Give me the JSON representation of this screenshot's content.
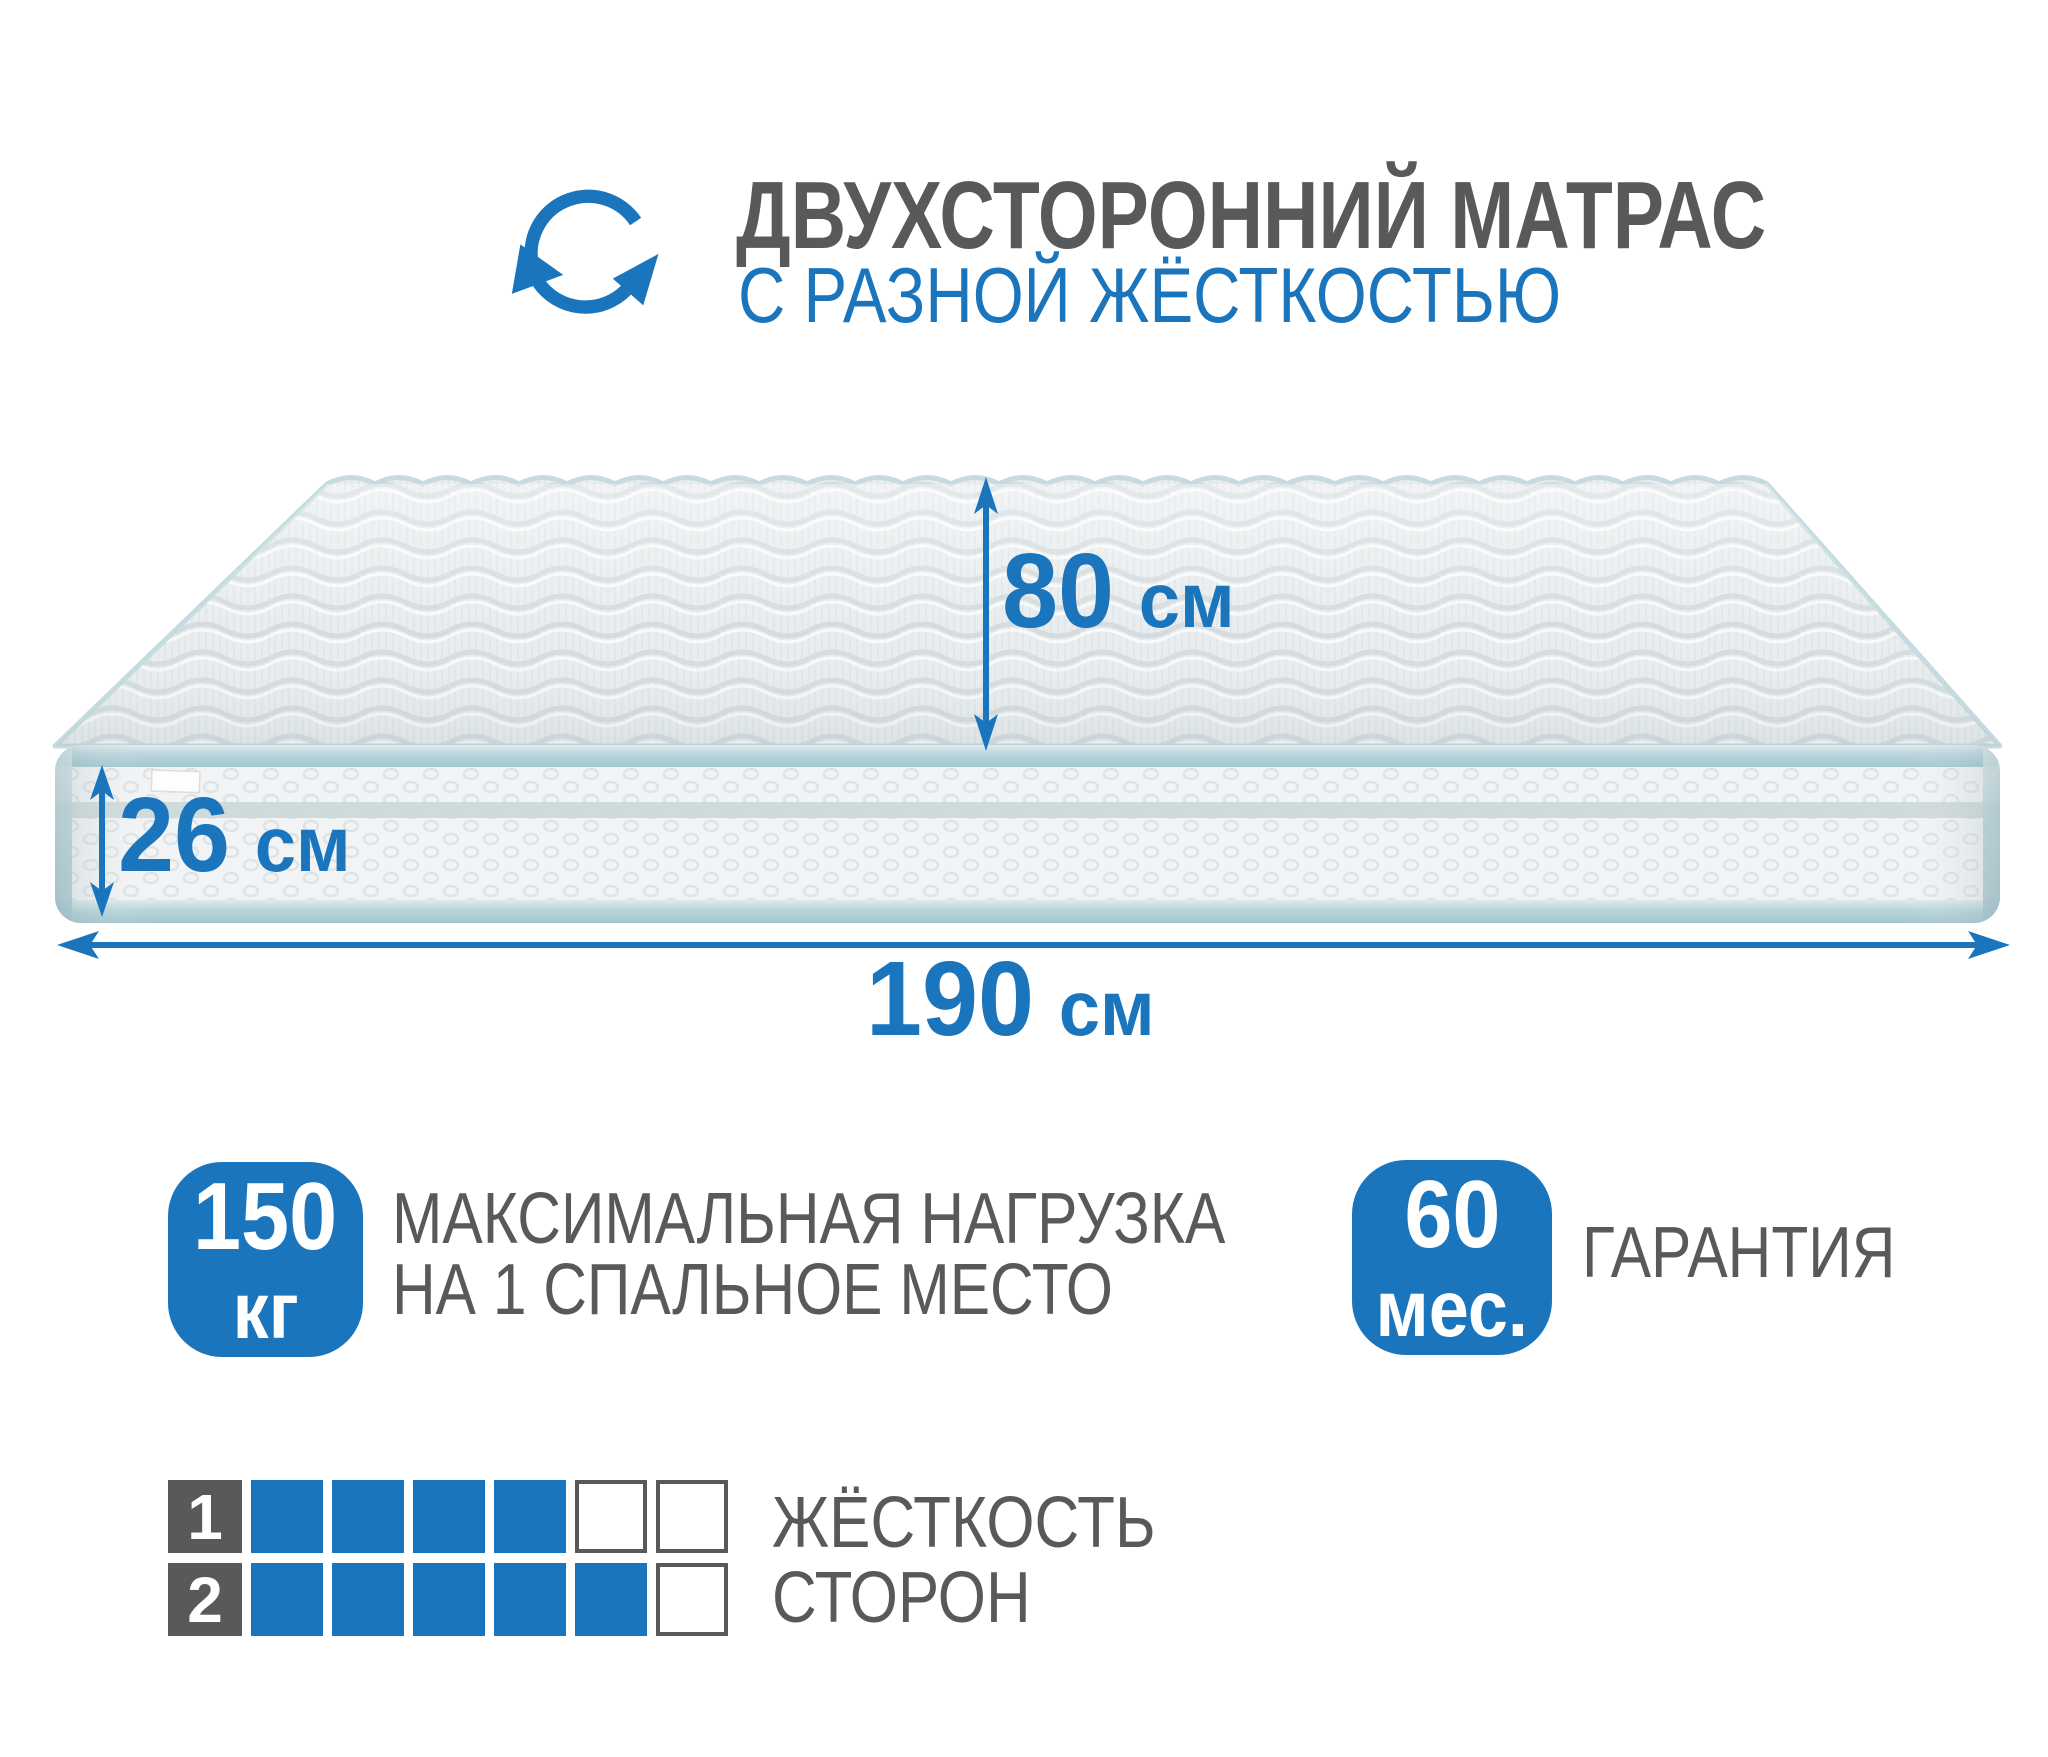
{
  "header": {
    "icon": "rotate-arrows-icon",
    "title": "ДВУХСТОРОННИЙ МАТРАС",
    "subtitle": "С РАЗНОЙ ЖЁСТКОСТЬЮ"
  },
  "dimensions": {
    "width": {
      "value": "80",
      "unit": "см"
    },
    "height": {
      "value": "26",
      "unit": "см"
    },
    "length": {
      "value": "190",
      "unit": "см"
    }
  },
  "badges": {
    "max_load": {
      "value": "150",
      "unit": "кг",
      "line1": "МАКСИМАЛЬНАЯ НАГРУЗКА",
      "line2": "НА 1 СПАЛЬНОЕ МЕСТО"
    },
    "warranty": {
      "value": "60",
      "unit": "мес.",
      "label": "ГАРАНТИЯ"
    }
  },
  "firmness": {
    "rows": [
      {
        "label": "1",
        "filled": 4,
        "total": 6
      },
      {
        "label": "2",
        "filled": 5,
        "total": 6
      }
    ],
    "caption_line1": "ЖЁСТКОСТЬ",
    "caption_line2": "СТОРОН"
  },
  "colors": {
    "accent": "#1b75bc",
    "text": "#58595b"
  }
}
